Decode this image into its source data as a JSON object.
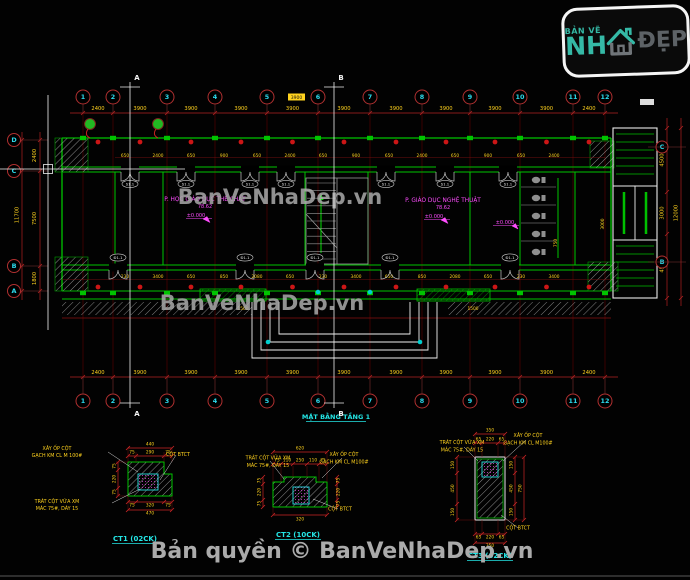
{
  "watermark": "BanVeNhaDep.vn",
  "copyright": "Bản quyền © BanVeNhaDep.vn",
  "logo": {
    "tagline": "BẢN VẼ",
    "name_left": "NH",
    "name_right": "ĐẸP"
  },
  "plan": {
    "title": "MẶT BẰNG TẦNG 1",
    "grid_cols": [
      "1",
      "2",
      "3",
      "4",
      "5",
      "6",
      "7",
      "8",
      "9",
      "10",
      "11",
      "12"
    ],
    "grid_rows": [
      "D",
      "C",
      "B",
      "A"
    ],
    "grid_rows_right": [
      "C",
      "B"
    ],
    "section_markers": [
      "A",
      "B"
    ],
    "dims_top": [
      "2400",
      "3900",
      "3900",
      "3900",
      "3900",
      "3900",
      "3900",
      "3900",
      "3900",
      "3900",
      "2400"
    ],
    "dims_bottom": [
      "2400",
      "3900",
      "3900",
      "3900",
      "3900",
      "3900",
      "3900",
      "3900",
      "3900",
      "3900",
      "2400"
    ],
    "dims_left": {
      "segments": [
        "2400",
        "7500",
        "1800"
      ],
      "overall": "11700"
    },
    "dims_right": {
      "segments": [
        "4500",
        "3000",
        "4500"
      ],
      "overall": "12000"
    },
    "dims_inner_top": [
      "650",
      "2400",
      "650",
      "900",
      "650",
      "2400",
      "650",
      "900",
      "650",
      "2400",
      "650",
      "900",
      "650",
      "2400"
    ],
    "dims_inner_bottom": [
      "230",
      "3400",
      "650",
      "850",
      "2080",
      "650",
      "230",
      "3400",
      "650",
      "850",
      "2080",
      "650",
      "230",
      "3400"
    ],
    "rooms": [
      {
        "name": "P. HỌC GIÁO DỤC THỂ CHẤT",
        "area": "78.62",
        "level": "±0.000"
      },
      {
        "name": "P. GIÁO DỤC NGHỆ THUẬT",
        "area": "78.62",
        "level": "±0.000"
      }
    ],
    "wc_level": "±0.000",
    "window_tag": "S1.1",
    "door_tag": "Đ1.1",
    "step_dim": "1500",
    "stair_width_dim": "3000",
    "wc_dim": "750",
    "selected_dim": "3900"
  },
  "details": [
    {
      "title": "CT1 (02CK)",
      "label_top": [
        "XÂY ỐP CỘT",
        "GẠCH KM CL M 100#"
      ],
      "label_bottom": [
        "TRÁT CỘT VỮA XM",
        "MÁC 75#, DÀY 15"
      ],
      "label_core": "CỘT BTCT",
      "overall_top": "440",
      "dims_top": [
        "75",
        "290",
        "75"
      ],
      "dims_left": [
        "75",
        "220",
        "75"
      ],
      "dims_bottom": [
        "75",
        "320",
        "75"
      ],
      "overall_bottom": "470"
    },
    {
      "title": "CT2 (10CK)",
      "label_left": [
        "TRÁT CỘT VỮA XM",
        "MÁC 75#, DÀY 15"
      ],
      "label_right": [
        "XÂY ỐP CỘT",
        "GẠCH KM CL M100#"
      ],
      "label_core": "CỘT BTCT",
      "overall_top": "620",
      "dims_top": [
        "75",
        "110",
        "250",
        "110",
        "75"
      ],
      "dims_left": [
        "75",
        "220",
        "75"
      ],
      "dims_right": [
        "75",
        "220",
        "75"
      ],
      "overall_bottom": "320"
    },
    {
      "title": "CT3 (02CK)",
      "label_left": [
        "TRÁT CỘT VỮA XM",
        "MÁC 75#, DÀY 15"
      ],
      "label_right": [
        "XÂY ỐP CỘT",
        "GẠCH KM CL M100#"
      ],
      "label_core": "CỘT BTCT",
      "overall_top": "350",
      "dims_top": [
        "65",
        "220",
        "65"
      ],
      "dims_left": [
        "150",
        "450",
        "150"
      ],
      "dims_right": [
        "150",
        "450",
        "150"
      ],
      "overall_right": "750",
      "dims_bottom": [
        "65",
        "220",
        "65"
      ],
      "overall_bottom": "350"
    }
  ]
}
